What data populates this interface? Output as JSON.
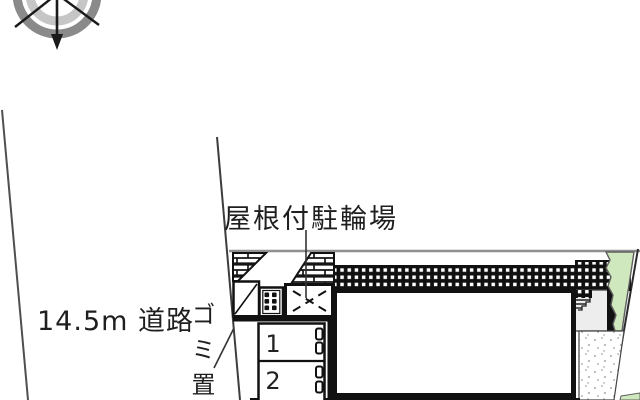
{
  "plan": {
    "type": "real-estate site plan",
    "labels": {
      "road_width": "14.5m 道路",
      "covered_bicycle_parking": "屋根付駐輪場",
      "garbage_area": "ゴミ置場"
    },
    "units": [
      {
        "number": "1"
      },
      {
        "number": "2"
      }
    ],
    "compass": {
      "icon": "compass-rose",
      "arrow_direction": "down"
    },
    "colors": {
      "line_black": "#1a1a1a",
      "boundary_gray": "#909090",
      "compass_outer_ring": "#8a8a8a",
      "compass_inner_ring": "#c6c6c6",
      "vegetation_green": "#cfe8bd",
      "porch_gray": "#ededed",
      "stipple_dot_gray": "#8a8a8a"
    }
  }
}
